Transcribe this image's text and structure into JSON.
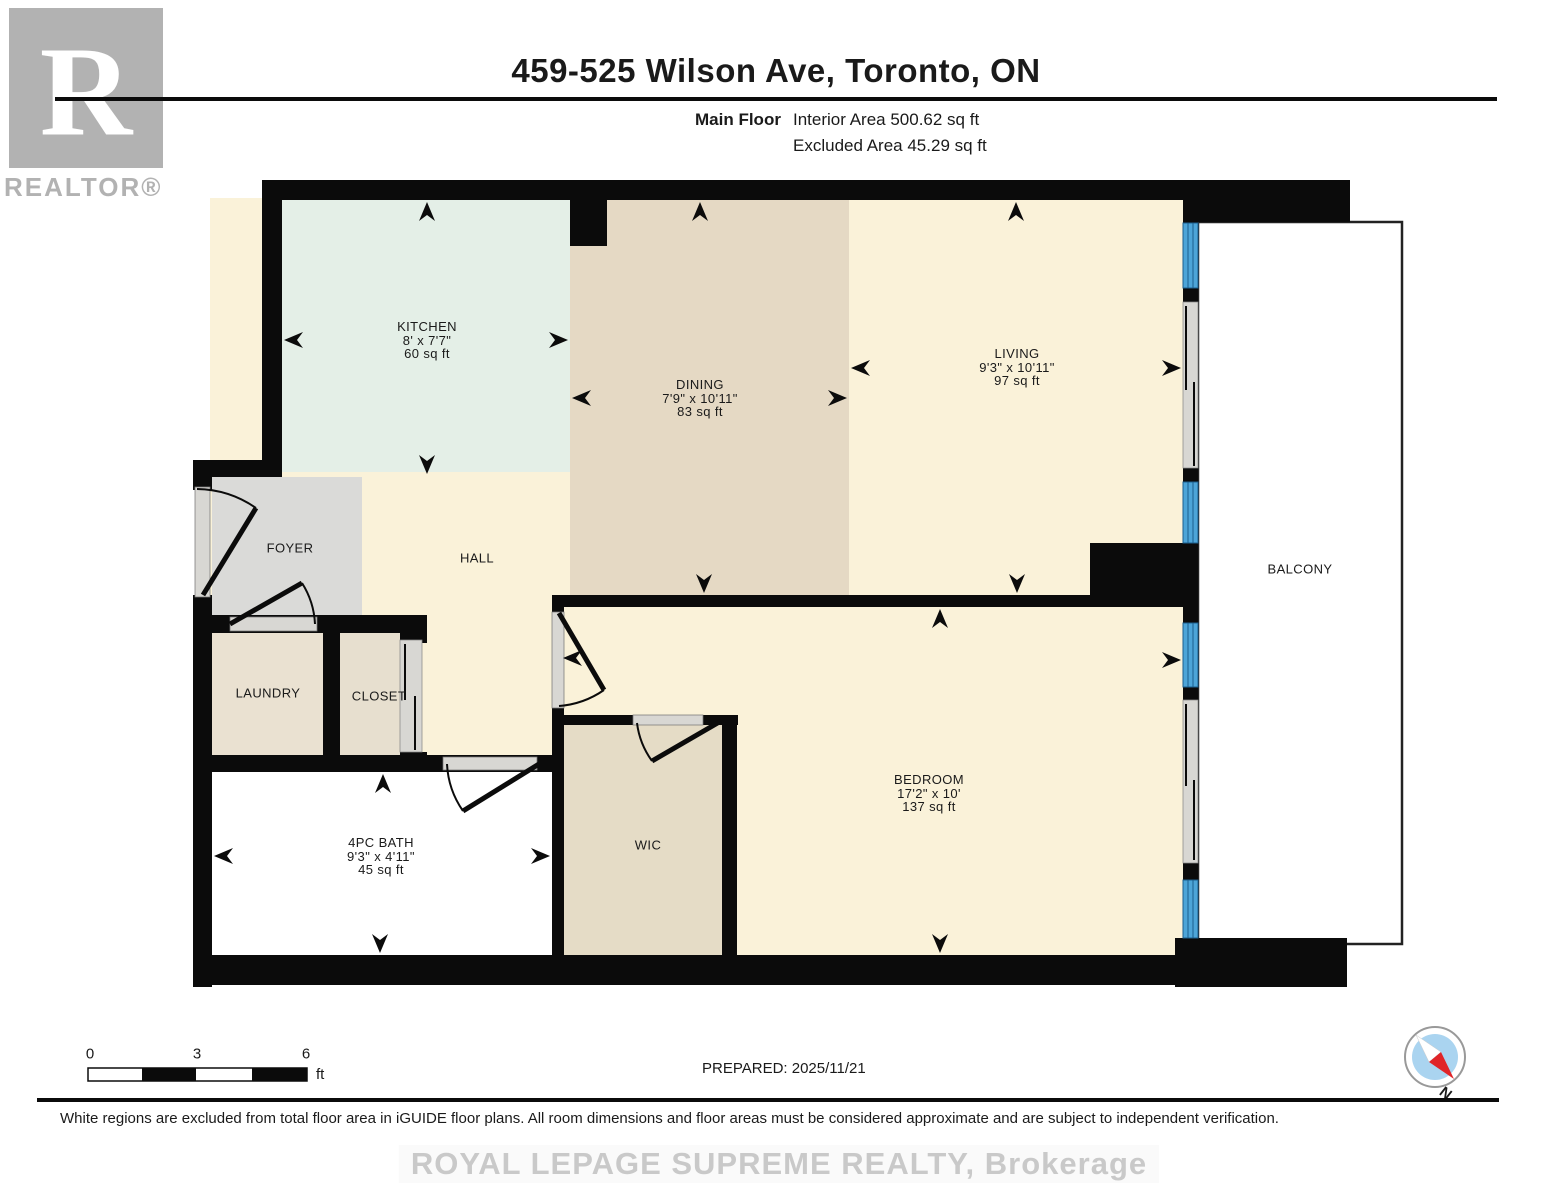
{
  "header": {
    "title": "459-525 Wilson Ave, Toronto, ON",
    "floor_label": "Main Floor",
    "interior_area": "Interior Area 500.62 sq ft",
    "excluded_area": "Excluded Area 45.29 sq ft"
  },
  "logo": {
    "letter": "R",
    "word": "REALTOR®"
  },
  "rooms": {
    "kitchen": {
      "name": "KITCHEN",
      "dims": "8' x 7'7\"",
      "area": "60 sq ft"
    },
    "dining": {
      "name": "DINING",
      "dims": "7'9\" x 10'11\"",
      "area": "83 sq ft"
    },
    "living": {
      "name": "LIVING",
      "dims": "9'3\" x 10'11\"",
      "area": "97 sq ft"
    },
    "foyer": {
      "name": "FOYER"
    },
    "hall": {
      "name": "HALL"
    },
    "laundry": {
      "name": "LAUNDRY"
    },
    "closet": {
      "name": "CLOSET"
    },
    "bath": {
      "name": "4PC BATH",
      "dims": "9'3\" x 4'11\"",
      "area": "45 sq ft"
    },
    "wic": {
      "name": "WIC"
    },
    "bedroom": {
      "name": "BEDROOM",
      "dims": "17'2\" x 10'",
      "area": "137 sq ft"
    },
    "balcony": {
      "name": "BALCONY"
    }
  },
  "scale_bar": {
    "tick0": "0",
    "tick1": "3",
    "tick2": "6",
    "unit": "ft"
  },
  "footer": {
    "prepared": "PREPARED: 2025/11/21",
    "disclaimer": "White regions are excluded from total floor area in iGUIDE floor plans. All room dimensions and floor areas must be considered approximate and are subject to independent verification.",
    "watermark": "ROYAL LEPAGE SUPREME REALTY, Brokerage"
  },
  "compass": {
    "label": "N"
  },
  "colors": {
    "wall": "#0b0b0b",
    "cream": "#faf2d9",
    "mint": "#e4efe7",
    "tan": "#e5d9c4",
    "foyer_gray": "#dadad8",
    "laundry": "#eae1d1",
    "closet": "#e7dfcf",
    "wic": "#e5dcc6",
    "bath": "#ffffff",
    "window_blue": "#4da5d8",
    "window_line": "#1c5f8e",
    "sill": "#d8d7d3",
    "balcony_line": "#222222",
    "logo_gray": "#b2b2b2",
    "watermark": "#c9c9c9",
    "needle_red": "#e02428",
    "compass_blue": "#aad4f0"
  }
}
